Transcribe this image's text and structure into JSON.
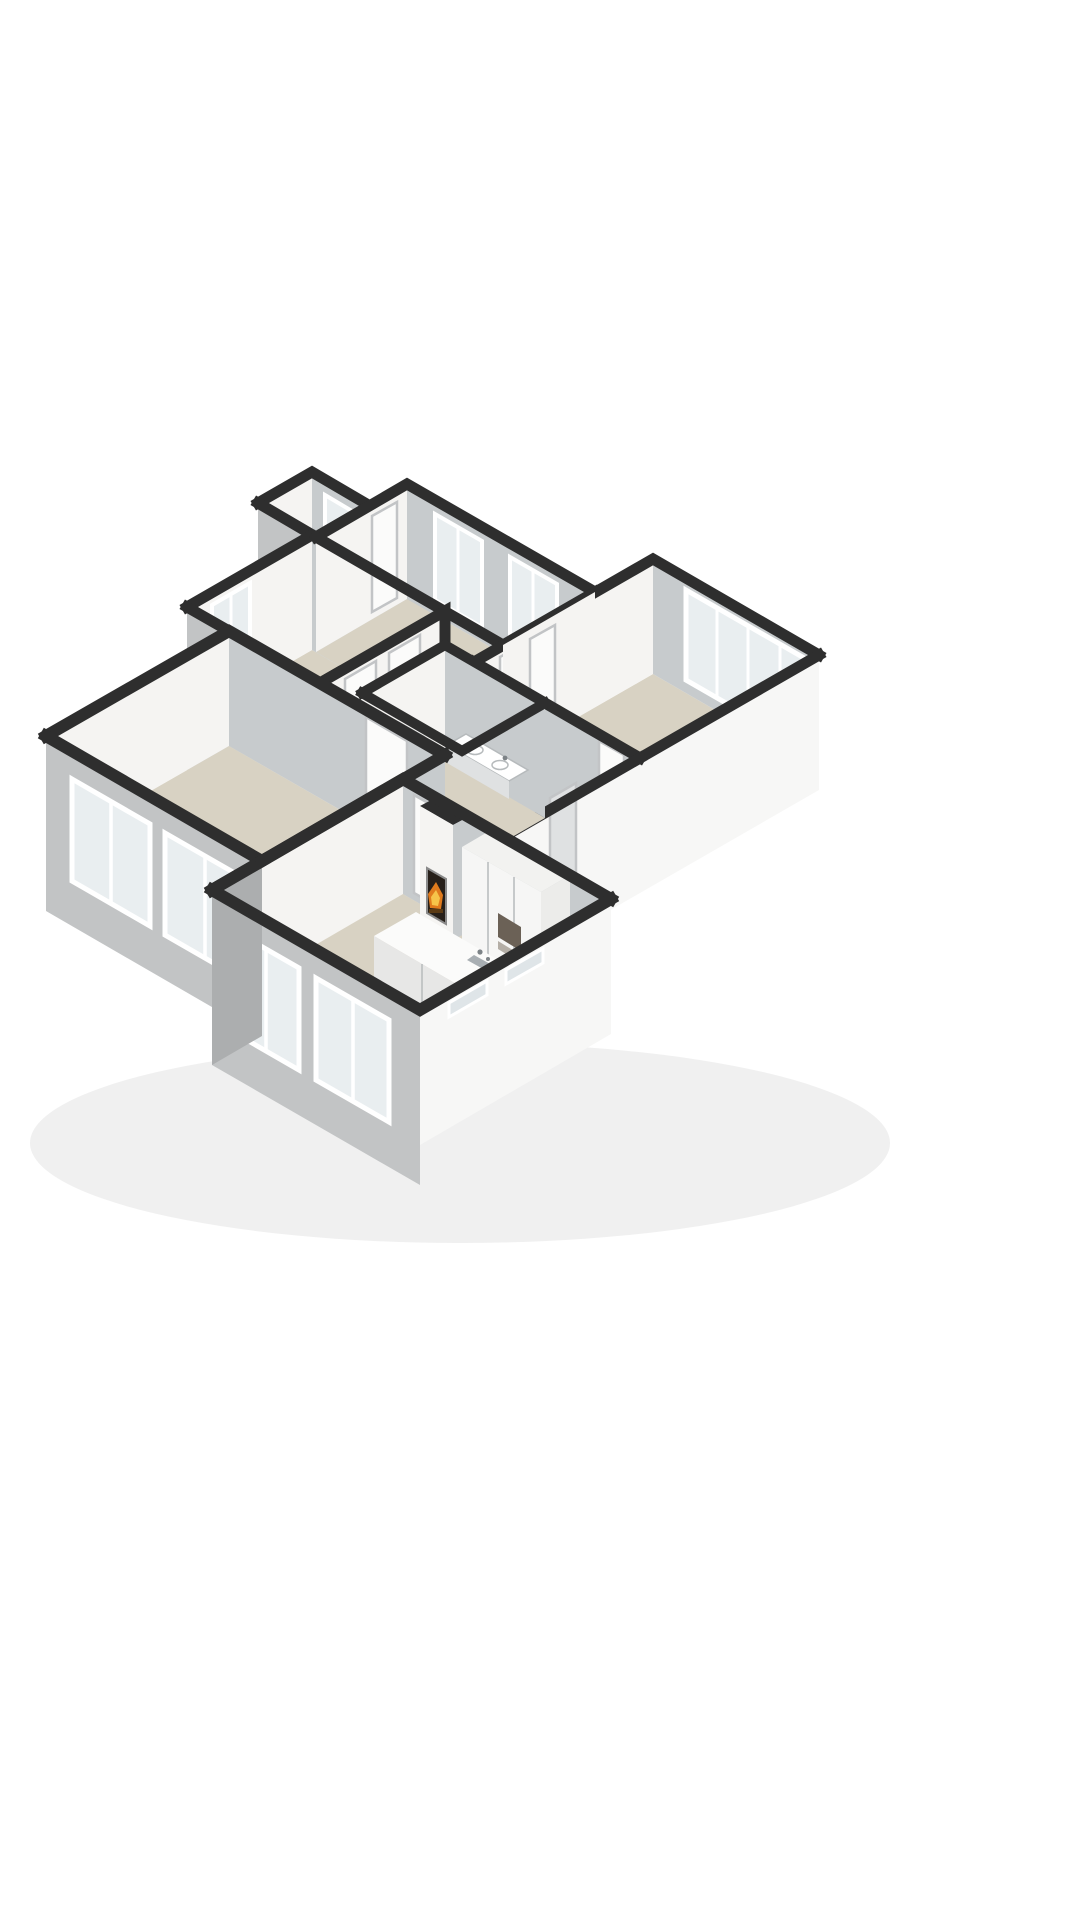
{
  "scene": {
    "name": "isometric-3d-floor-plan-render",
    "background": "#ffffff"
  },
  "colors": {
    "bg": "#ffffff",
    "wallTop": "#2e2e2e",
    "innerFaceLight": "#f5f4f2",
    "innerFaceShade": "#c7cbcd",
    "innerFaceMid": "#dfe1e2",
    "facadeGray": "#c2c4c5",
    "facadeGrayDark": "#acaeaf",
    "facadeWhite": "#f7f7f6",
    "floorMain": "#d8d2c3",
    "floorShade": "#cfc9bb",
    "glass": "#e9eef0",
    "glassDim": "#dfe5e8",
    "frame": "#ffffff",
    "frameStroke": "#b7babc",
    "doorWhite": "#fbfbfa",
    "doorStroke": "#c2c4c6",
    "firebox": "#261f19",
    "fireboxFrame": "#8a8a8a",
    "flameOuter": "#e07b1d",
    "flameInner": "#f6c44a",
    "emberDark": "#5a3a14",
    "metal": "#a9afb3",
    "metalDark": "#7d8387",
    "islandTop": "#fbfbfa",
    "islandFaceSW": "#e7e7e6",
    "islandFaceSE": "#f0f0ef",
    "cabinetFace": "#f6f6f5",
    "cabinetSide": "#ececea",
    "cabinetTop": "#f2f2f0",
    "applianceDark": "#6b6156",
    "applianceSteel": "#b4aea6",
    "porcelain": "#ffffff",
    "porcelainStroke": "#b6babc",
    "shadow": "rgba(60,60,60,0.08)"
  },
  "rooms": [
    {
      "id": "living-room"
    },
    {
      "id": "kitchen-living-room"
    },
    {
      "id": "bedroom-1"
    },
    {
      "id": "bedroom-2"
    },
    {
      "id": "bedroom-3"
    },
    {
      "id": "bathroom"
    },
    {
      "id": "hallway"
    },
    {
      "id": "porch"
    }
  ],
  "objects": [
    {
      "id": "fireplace"
    },
    {
      "id": "kitchen-island"
    },
    {
      "id": "island-sink"
    },
    {
      "id": "tall-cabinets"
    },
    {
      "id": "built-in-oven"
    },
    {
      "id": "corner-sink"
    },
    {
      "id": "vanity-double-sink"
    },
    {
      "id": "toilet"
    },
    {
      "id": "windows"
    },
    {
      "id": "doors"
    }
  ]
}
